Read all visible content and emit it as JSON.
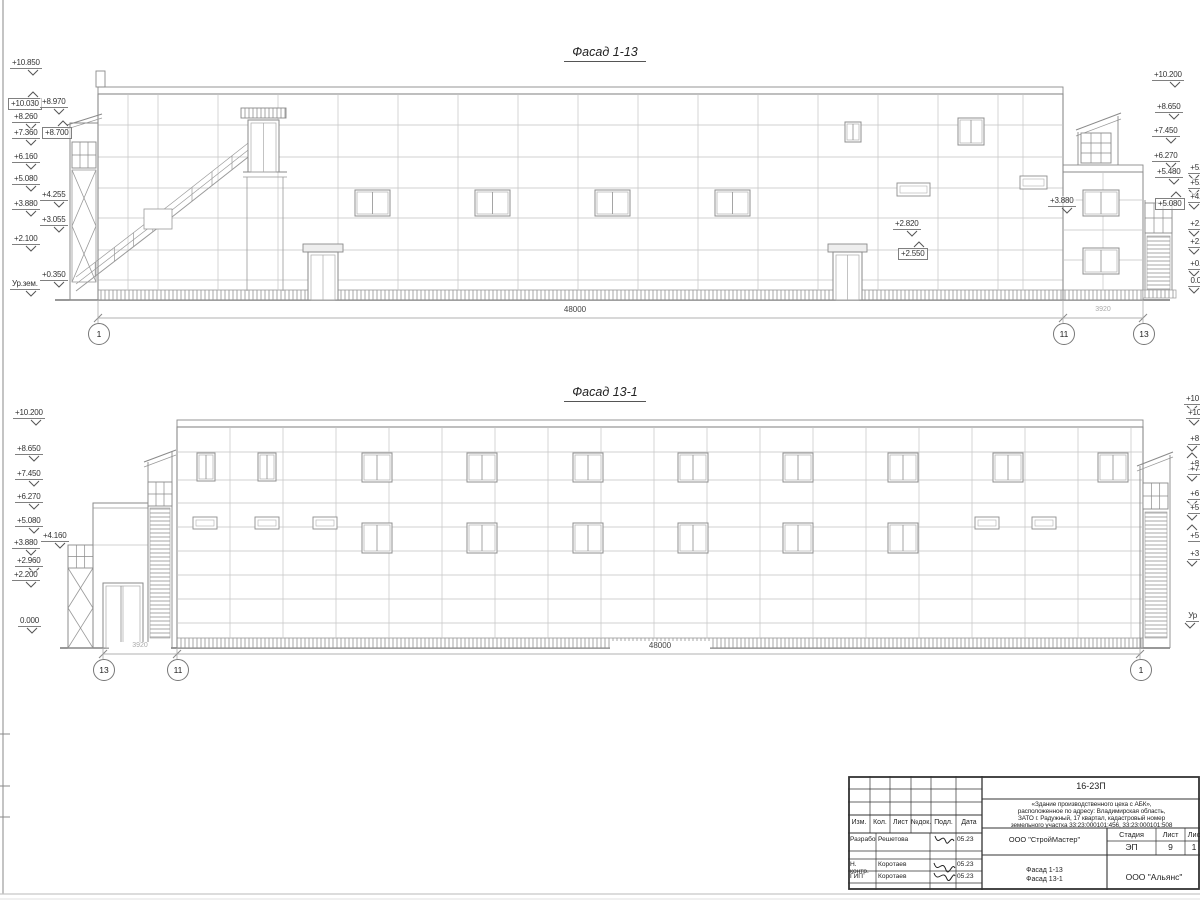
{
  "sheet": {
    "facade1": {
      "title": "Фасад 1-13",
      "dim_main": "48000",
      "dim_side": "3920",
      "axes": [
        {
          "label": "1",
          "cx": 98,
          "cy": 333
        },
        {
          "label": "11",
          "cx": 1063,
          "cy": 333
        },
        {
          "label": "13",
          "cx": 1143,
          "cy": 333
        }
      ],
      "marks": [
        {
          "label": "+10.850",
          "x": 10,
          "y": 58
        },
        {
          "label": "+10.030",
          "x": 8,
          "y": 91,
          "boxed": true,
          "arrow": "up"
        },
        {
          "label": "+8.970",
          "x": 40,
          "y": 97
        },
        {
          "label": "+8.260",
          "x": 12,
          "y": 112
        },
        {
          "label": "+8.700",
          "x": 42,
          "y": 120,
          "boxed": true,
          "arrow": "up"
        },
        {
          "label": "+7.360",
          "x": 12,
          "y": 128
        },
        {
          "label": "+6.160",
          "x": 12,
          "y": 152
        },
        {
          "label": "+5.080",
          "x": 12,
          "y": 174
        },
        {
          "label": "+4.255",
          "x": 40,
          "y": 190
        },
        {
          "label": "+3.880",
          "x": 12,
          "y": 199
        },
        {
          "label": "+3.055",
          "x": 40,
          "y": 215
        },
        {
          "label": "+2.100",
          "x": 12,
          "y": 234
        },
        {
          "label": "+0.350",
          "x": 40,
          "y": 270
        },
        {
          "label": "Ур.зем.",
          "x": 10,
          "y": 279
        },
        {
          "label": "+10.200",
          "x": 1152,
          "y": 70
        },
        {
          "label": "+8.650",
          "x": 1155,
          "y": 102
        },
        {
          "label": "+7.450",
          "x": 1152,
          "y": 126
        },
        {
          "label": "+6.270",
          "x": 1152,
          "y": 151
        },
        {
          "label": "+5.480",
          "x": 1155,
          "y": 167
        },
        {
          "label": "+5.080",
          "x": 1155,
          "y": 191,
          "boxed": true,
          "arrow": "up"
        },
        {
          "label": "+3.880",
          "x": 1048,
          "y": 196
        },
        {
          "label": "+2.820",
          "x": 893,
          "y": 219
        },
        {
          "label": "+2.550",
          "x": 898,
          "y": 241,
          "boxed": true,
          "arrow": "up"
        },
        {
          "label": "+5.",
          "x": 1188,
          "y": 163
        },
        {
          "label": "+5.",
          "x": 1188,
          "y": 178
        },
        {
          "label": "+4.",
          "x": 1188,
          "y": 192
        },
        {
          "label": "+2.",
          "x": 1188,
          "y": 219
        },
        {
          "label": "+2.",
          "x": 1188,
          "y": 237
        },
        {
          "label": "+0.",
          "x": 1188,
          "y": 259
        },
        {
          "label": "0.0",
          "x": 1188,
          "y": 276
        }
      ]
    },
    "facade2": {
      "title": "Фасад 13-1",
      "dim_main": "48000",
      "dim_side": "3920",
      "axes": [
        {
          "label": "13",
          "cx": 103,
          "cy": 669
        },
        {
          "label": "11",
          "cx": 177,
          "cy": 669
        },
        {
          "label": "1",
          "cx": 1140,
          "cy": 669
        }
      ],
      "marks": [
        {
          "label": "+10.200",
          "x": 13,
          "y": 408
        },
        {
          "label": "+8.650",
          "x": 15,
          "y": 444
        },
        {
          "label": "+7.450",
          "x": 15,
          "y": 469
        },
        {
          "label": "+6.270",
          "x": 15,
          "y": 492
        },
        {
          "label": "+5.080",
          "x": 15,
          "y": 516
        },
        {
          "label": "+4.160",
          "x": 41,
          "y": 531
        },
        {
          "label": "+3.880",
          "x": 12,
          "y": 538
        },
        {
          "label": "+2.960",
          "x": 15,
          "y": 556
        },
        {
          "label": "+2.200",
          "x": 12,
          "y": 570
        },
        {
          "label": "0.000",
          "x": 18,
          "y": 616
        },
        {
          "label": "+10",
          "x": 1184,
          "y": 394
        },
        {
          "label": "+10",
          "x": 1186,
          "y": 408
        },
        {
          "label": "+8",
          "x": 1186,
          "y": 434
        },
        {
          "label": "+8",
          "x": 1186,
          "y": 452,
          "arrow": "up"
        },
        {
          "label": "+7",
          "x": 1186,
          "y": 464
        },
        {
          "label": "+6",
          "x": 1186,
          "y": 489
        },
        {
          "label": "+5",
          "x": 1186,
          "y": 503
        },
        {
          "label": "+5",
          "x": 1186,
          "y": 524,
          "arrow": "up"
        },
        {
          "label": "+3",
          "x": 1186,
          "y": 549
        },
        {
          "label": "Ур",
          "x": 1184,
          "y": 611
        }
      ]
    }
  },
  "titleblock": {
    "code": "16-23П",
    "desc": [
      "«Здание производственного цеха с АБК»,",
      "расположенное по адресу: Владимирская область,",
      "ЗАТО г. Радужный, 17 квартал, кадастровый номер",
      "земельного участка 33:23:000101:456, 33:23:000101:508"
    ],
    "cols": [
      "Изм.",
      "Кол.",
      "Лист",
      "№док.",
      "Подл.",
      "Дата"
    ],
    "rows": [
      {
        "role": "Разработал",
        "name": "Решетова",
        "date": "05.23"
      },
      {
        "role": "Н. контр.",
        "name": "Коротаев",
        "date": "05.23"
      },
      {
        "role": "ГИП",
        "name": "Коротаев",
        "date": "05.23"
      }
    ],
    "org1": "ООО \"СтройМастер\"",
    "stage_headers": [
      "Стадия",
      "Лист",
      "Лис"
    ],
    "stage_values": [
      "ЭП",
      "9",
      "1"
    ],
    "sheet_name1": "Фасад 1-13",
    "sheet_name2": "Фасад 13-1",
    "org2": "ООО \"Альянс\""
  },
  "colors": {
    "line_light": "#c3c3c3",
    "line_mid": "#999999",
    "line_dark": "#8a8a8a",
    "ground": "#777777",
    "text": "#333333",
    "tb_border": "#333333"
  }
}
